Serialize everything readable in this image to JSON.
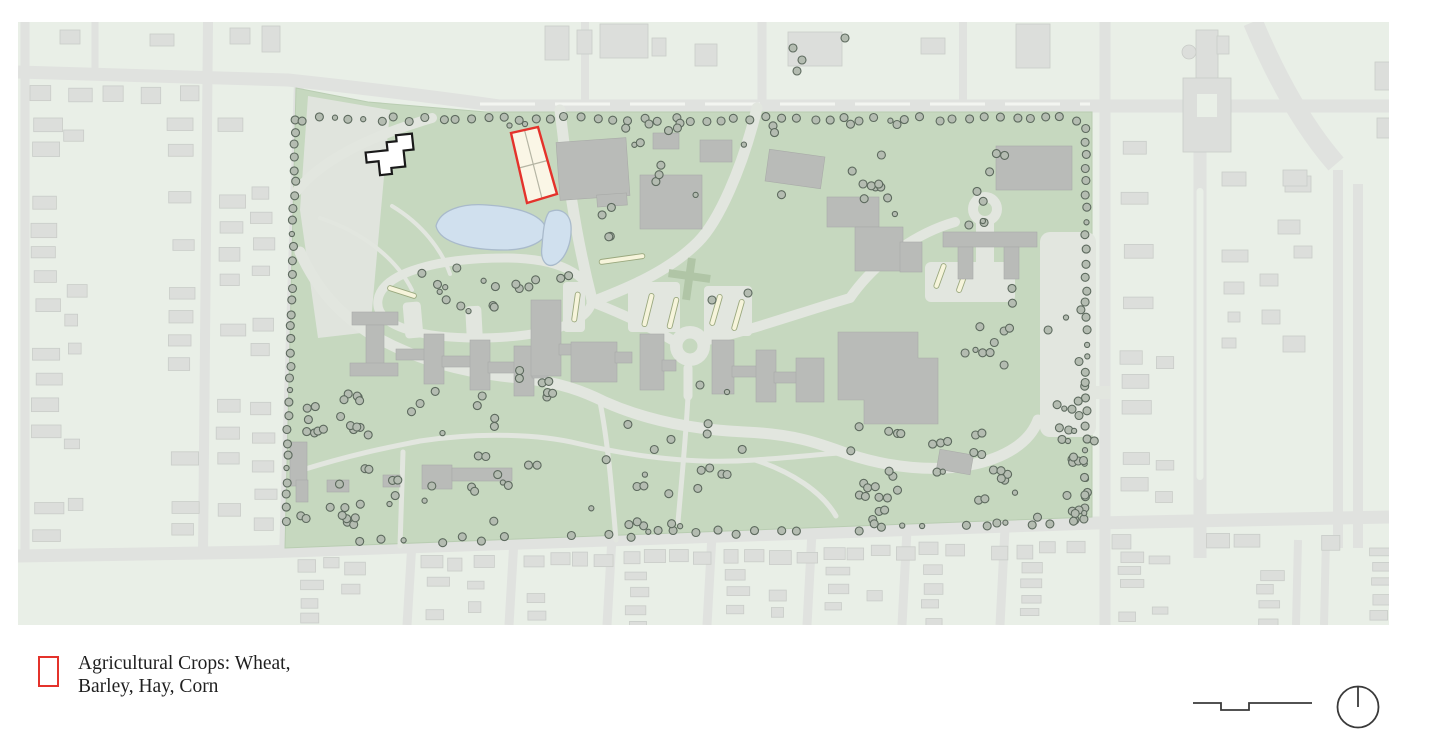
{
  "title": "Institutional campus site plan with highlighted parcel",
  "legend": {
    "swatch_color": "#e4322b",
    "line1": "Agricultural Crops: Wheat,",
    "line2": "Barley, Hay, Corn"
  },
  "footer": {
    "scale_bar_icon": "scale-bar",
    "north_arrow_icon": "north-arrow"
  },
  "map": {
    "type": "site-plan",
    "features": [
      "city-blocks-with-houses",
      "campus-lawn",
      "main-building-complex",
      "pond",
      "agricultural-crops-parcel",
      "greenhouse-outline-building",
      "roundabouts",
      "perimeter-tree-rows"
    ],
    "colors": {
      "page_bg": "#ffffff",
      "city_bg": "#e9efe7",
      "street": "#e0e2df",
      "street_dash": "#f3f5f1",
      "city_building": "#dcdedb",
      "city_building_edge": "#c9ccc8",
      "campus_green": "#c6d8bf",
      "campus_edge": "#b9cdb2",
      "campus_path": "#e2e6df",
      "field": "#e0e4dd",
      "building": "#b9bbb8",
      "building_edge": "#a9aba8",
      "tree_fill": "#b4bcb1",
      "tree_stroke": "#5d6a5e",
      "water_fill": "#d0e0ee",
      "water_stroke": "#a9bacb",
      "bed_fill": "#f6f4db",
      "bed_stroke": "#9aa87e",
      "cross_green": "#b0c5a6",
      "highlight_fill": "#faf6e6",
      "highlight_stroke": "#e4322b",
      "outline_building_fill": "#ffffff",
      "outline_building_stroke": "#1a1a1a",
      "icon_stroke": "#3a3a3a"
    }
  }
}
